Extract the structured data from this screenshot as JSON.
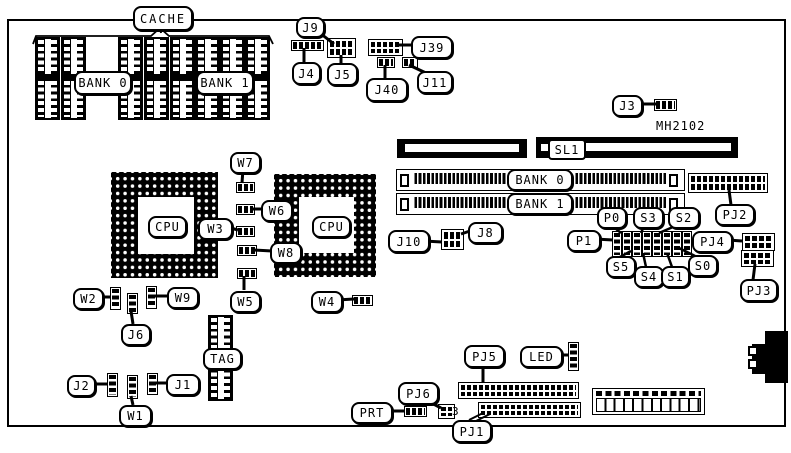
{
  "colors": {
    "foreground": "#000000",
    "background": "#ffffff"
  },
  "texts": {
    "mh2102": "MH2102",
    "pj6_pin3": "3"
  },
  "labels": {
    "cache": "CACHE",
    "cache_bank0": "BANK 0",
    "cache_bank1": "BANK 1",
    "j9": "J9",
    "j4": "J4",
    "j5": "J5",
    "j39": "J39",
    "j40": "J40",
    "j11": "J11",
    "j3": "J3",
    "sl1": "SL1",
    "simm_bank0": "BANK 0",
    "simm_bank1": "BANK 1",
    "pj2": "PJ2",
    "p0": "P0",
    "s3": "S3",
    "s2": "S2",
    "p1": "P1",
    "pj4": "PJ4",
    "s5": "S5",
    "s4": "S4",
    "s1": "S1",
    "s0": "S0",
    "pj3": "PJ3",
    "j10": "J10",
    "j8": "J8",
    "w7": "W7",
    "w6": "W6",
    "w3": "W3",
    "w8": "W8",
    "w5": "W5",
    "cpu_left": "CPU",
    "cpu_right": "CPU",
    "w2": "W2",
    "w9": "W9",
    "j6": "J6",
    "w4": "W4",
    "tag": "TAG",
    "j2": "J2",
    "j1": "J1",
    "w1": "W1",
    "pj5": "PJ5",
    "led": "LED",
    "pj6": "PJ6",
    "prt": "PRT",
    "pj1": "PJ1"
  }
}
